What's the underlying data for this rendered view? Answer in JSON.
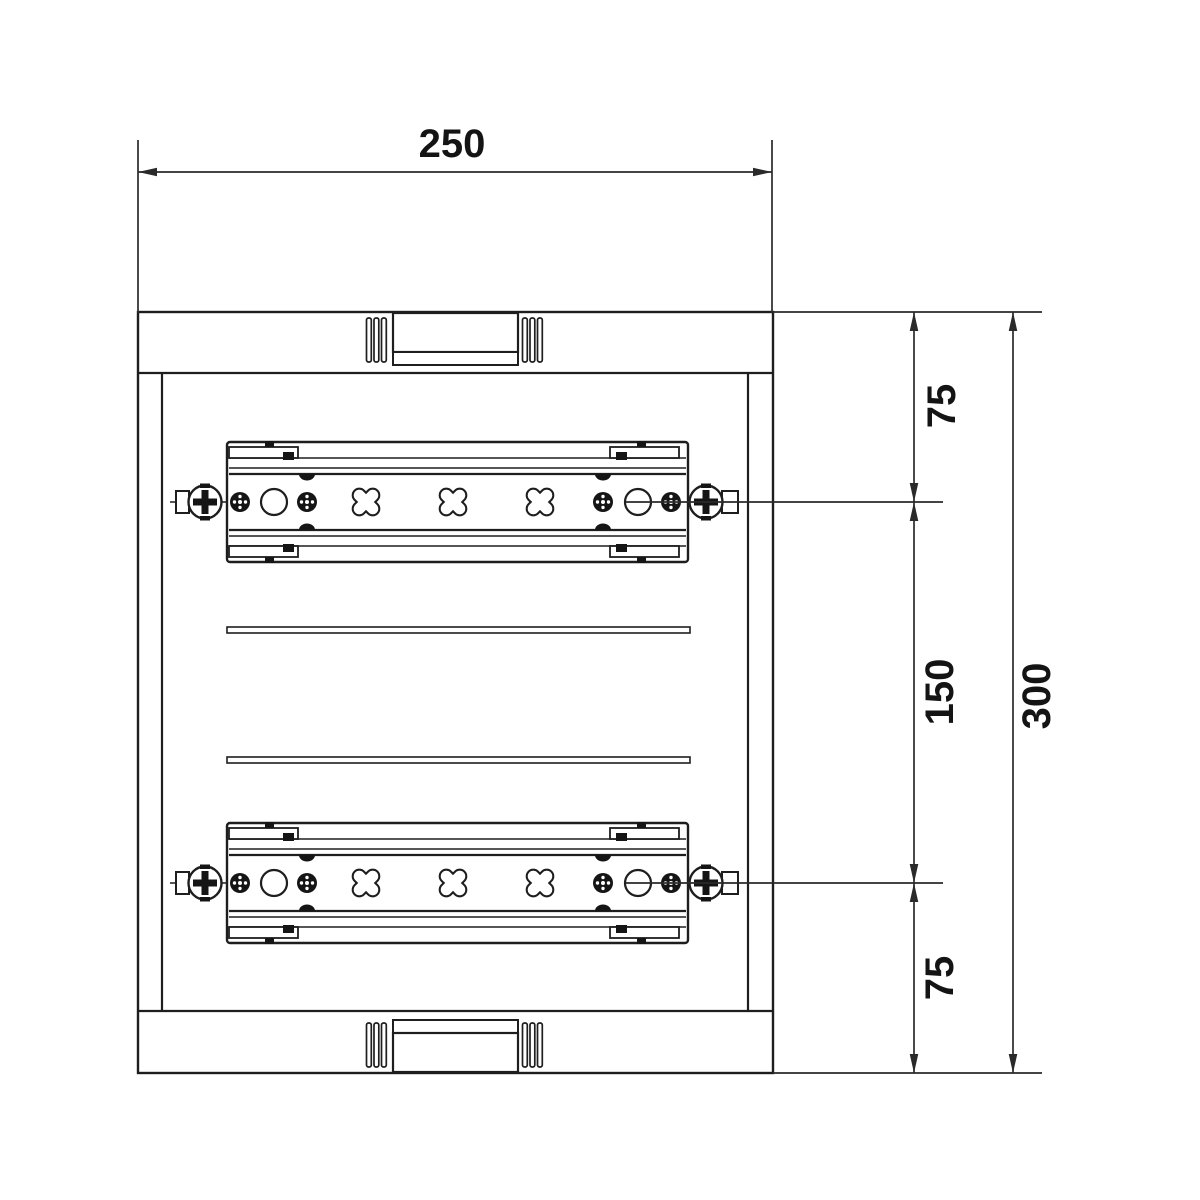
{
  "drawing": {
    "type": "technical-dimension-drawing",
    "subject": "enclosure-front-view-with-two-din-rails",
    "dimensions": {
      "width": "250",
      "top_offset": "75",
      "rail_spacing": "150",
      "bottom_offset": "75",
      "total_height": "300"
    },
    "colors": {
      "line": "#1e1e1e",
      "dimension_line": "#2a2a2a",
      "background": "#ffffff"
    }
  }
}
